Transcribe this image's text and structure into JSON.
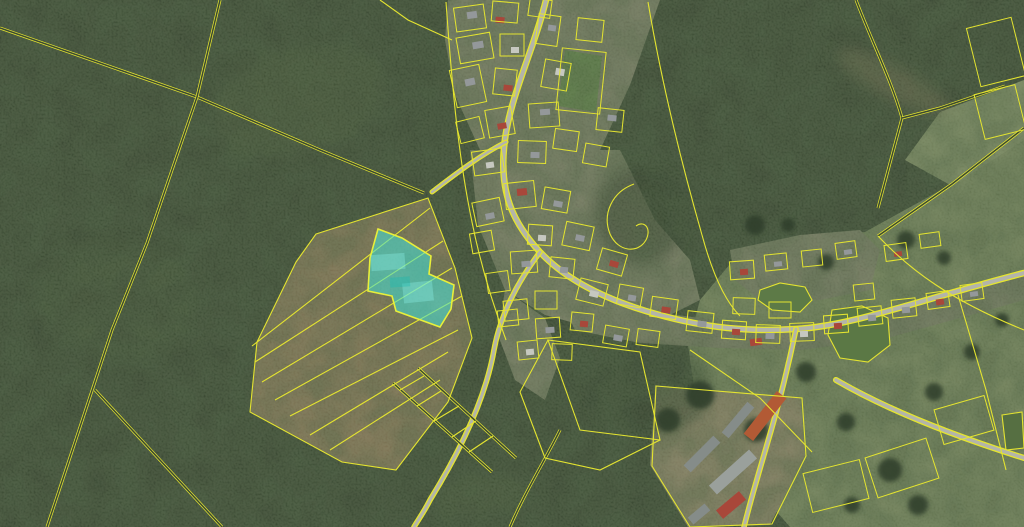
{
  "map": {
    "width": 1024,
    "height": 527,
    "colors": {
      "forest": "#3b4a34",
      "forest_core": "#3a4833",
      "village_ground": "#8f9177",
      "field_tan": "#a28a66",
      "farm_dirt": "#a79879",
      "meadow": "#8b9b6d",
      "meadow_light": "#97a677",
      "sports_green": "#6f9752",
      "road_gray": "#b3b4aa",
      "parcel_line": "#e4e430",
      "water": "#5d7a47",
      "highlight_fill": "#3fe2d7",
      "highlight_stroke": "#e8ef3a",
      "tree": "#2f3d29",
      "roofs": {
        "g": "#94989a",
        "g2": "#858c89",
        "g3": "#9aa09c",
        "r": "#a8473a",
        "o": "#b25a35",
        "w": "#c6c8c0",
        "d": "#6e756f"
      }
    },
    "regions": [
      {
        "name": "forest-base",
        "points": "0,0 1024,0 1024,527 0,527",
        "fill": "#3b4a34",
        "opacity": 1
      },
      {
        "name": "meadow-main",
        "points": "700,430 688,345 700,300 735,258 800,238 865,232 950,185 1024,135 1024,527 790,527 742,472",
        "fill": "#8b9b6d",
        "opacity": 1
      },
      {
        "name": "meadow-top-patch",
        "points": "940,112 1024,80 1024,140 952,186 905,160",
        "fill": "#97a677",
        "opacity": 1
      },
      {
        "name": "field-tan",
        "points": "316,234 428,198 455,268 472,338 448,402 396,470 342,462 250,412 257,342 296,262",
        "fill": "#a28a66",
        "opacity": 1
      },
      {
        "name": "farm-dirt",
        "points": "655,385 800,398 805,455 770,525 688,527 650,465",
        "fill": "#a79879",
        "opacity": 1
      },
      {
        "name": "village-top",
        "points": "448,0 660,0 630,85 600,150 560,160 520,160 480,150 455,95 445,40",
        "fill": "#8f9177",
        "opacity": 1
      },
      {
        "name": "village-mid",
        "points": "470,150 620,150 655,220 690,260 700,300 660,320 600,330 545,315 505,290 478,225",
        "fill": "#8f9177",
        "opacity": 1
      },
      {
        "name": "village-east-row",
        "points": "560,300 700,318 760,328 860,318 960,293 1024,270 1024,300 960,318 880,340 800,350 720,348 640,343 575,330",
        "fill": "#8f9177",
        "opacity": 1
      },
      {
        "name": "village-pond-row",
        "points": "730,250 800,235 860,230 880,250 870,290 820,300 760,300 735,280",
        "fill": "#8f9177",
        "opacity": 1
      },
      {
        "name": "village-south-tail",
        "points": "505,290 545,318 560,358 545,400 515,380 498,335",
        "fill": "#8f9177",
        "opacity": 1
      },
      {
        "name": "sports-field",
        "points": "565,50 602,56 596,112 558,106",
        "fill": "#6f9752",
        "opacity": 1
      }
    ],
    "soft_patches": [
      {
        "name": "logging-trail",
        "cx": 893,
        "cy": 82,
        "rx": 62,
        "ry": 16,
        "rot": 28,
        "fill": "#8f7f60",
        "opacity": 0.5
      },
      {
        "name": "light-forest-nw",
        "cx": 300,
        "cy": 100,
        "rx": 90,
        "ry": 55,
        "rot": -15,
        "fill": "#4d5f3d",
        "opacity": 0.5
      },
      {
        "name": "light-forest-w",
        "cx": 120,
        "cy": 300,
        "rx": 80,
        "ry": 60,
        "rot": 10,
        "fill": "#455739",
        "opacity": 0.5
      },
      {
        "name": "clearing-bottom",
        "cx": 480,
        "cy": 495,
        "rx": 50,
        "ry": 22,
        "rot": -10,
        "fill": "#4f6140",
        "opacity": 0.5
      },
      {
        "name": "dark-forest-center",
        "cx": 640,
        "cy": 215,
        "rx": 45,
        "ry": 50,
        "rot": 0,
        "fill": "#32402b",
        "opacity": 0.6
      },
      {
        "name": "forest-tongue-south",
        "cx": 650,
        "cy": 390,
        "rx": 60,
        "ry": 45,
        "rot": 0,
        "fill": "#36452e",
        "opacity": 0.6
      }
    ],
    "ponds": [
      {
        "name": "pond-west",
        "points": "760,290 780,283 805,287 812,300 800,312 772,310 758,300",
        "fill": "#5d7a47"
      },
      {
        "name": "pond-east",
        "points": "832,310 862,306 888,318 890,345 868,362 840,358 828,335",
        "fill": "#5b7845"
      },
      {
        "name": "pond-corner",
        "points": "1002,415 1022,412 1024,448 1006,450",
        "fill": "#566f42"
      }
    ],
    "roads": [
      {
        "name": "main-street",
        "d": "M 546,0 C 534,50 508,100 504,148 C 500,192 512,222 540,252 C 566,280 606,300 656,314 C 706,328 748,332 796,329 C 852,326 912,302 1024,273",
        "width": 4
      },
      {
        "name": "south-road",
        "d": "M 540,252 C 516,284 500,316 494,350 C 486,396 462,448 430,500 C 424,512 418,520 414,527",
        "width": 3
      },
      {
        "name": "farm-road",
        "d": "M 796,329 C 788,368 778,408 766,448 C 758,476 750,502 744,527",
        "width": 3
      },
      {
        "name": "southeast-road",
        "d": "M 836,380 C 884,408 948,434 1024,458",
        "width": 3.5
      },
      {
        "name": "west-spur",
        "d": "M 506,142 C 482,154 458,172 432,192",
        "width": 2.5
      }
    ],
    "double_lines": [
      {
        "name": "boundary-nw-diagonal",
        "d": "M 0,28 L 197,97 L 320,150 L 424,193"
      },
      {
        "name": "boundary-w-vertical",
        "d": "M 220,0 L 197,97 L 147,243 L 112,330 L 47,527"
      },
      {
        "name": "boundary-sw-branch",
        "d": "M 95,390 L 222,527"
      },
      {
        "name": "boundary-ne",
        "d": "M 856,0 C 872,42 892,82 902,118 L 878,208"
      },
      {
        "name": "boundary-ne-spur",
        "d": "M 902,118 L 940,108 L 1005,86"
      },
      {
        "name": "meadow-top-edge",
        "d": "M 1024,128 L 952,184 L 878,236"
      },
      {
        "name": "boundary-s-center",
        "d": "M 560,430 C 544,462 524,494 510,527"
      },
      {
        "name": "ladder-rail-1",
        "d": "M 393,383 L 492,472"
      },
      {
        "name": "ladder-rail-2",
        "d": "M 418,368 L 516,458"
      }
    ],
    "single_lines": [
      {
        "name": "field-outline",
        "d": "M 316,234 L 428,198 L 455,268 L 472,338 L 448,402 L 396,470 L 342,462 L 250,412 L 257,342 L 296,262 Z"
      },
      {
        "name": "field-strip",
        "d": "M 252,346 L 430,208"
      },
      {
        "name": "field-strip",
        "d": "M 255,362 L 443,241"
      },
      {
        "name": "field-strip",
        "d": "M 262,382 L 452,268"
      },
      {
        "name": "field-strip",
        "d": "M 275,400 L 462,296"
      },
      {
        "name": "field-strip",
        "d": "M 290,416 L 458,330"
      },
      {
        "name": "field-strip",
        "d": "M 310,435 L 448,352"
      },
      {
        "name": "field-strip",
        "d": "M 330,450 L 440,380"
      },
      {
        "name": "ladder-rung",
        "d": "M 400,390 L 424,376"
      },
      {
        "name": "ladder-rung",
        "d": "M 417,406 L 441,391"
      },
      {
        "name": "ladder-rung",
        "d": "M 434,421 L 459,406"
      },
      {
        "name": "ladder-rung",
        "d": "M 452,437 L 476,421"
      },
      {
        "name": "ladder-rung",
        "d": "M 469,452 L 493,436"
      },
      {
        "name": "meadow-line",
        "d": "M 878,236 C 910,270 950,300 1024,330"
      },
      {
        "name": "meadow-line",
        "d": "M 690,350 L 760,398 L 812,452"
      },
      {
        "name": "meadow-line",
        "d": "M 958,295 L 986,390 L 1006,470"
      },
      {
        "name": "village-east-forest-edge",
        "d": "M 648,2 C 662,85 682,165 702,235 C 712,272 724,300 740,316"
      },
      {
        "name": "village-west-edge",
        "d": "M 446,2 C 452,85 458,155 472,222 C 480,262 492,302 506,340"
      },
      {
        "name": "hook-parcel",
        "d": "M 634,184 C 612,192 602,214 610,234 C 618,252 638,254 646,240 C 652,228 644,220 636,226"
      },
      {
        "name": "south-forest-parcel",
        "d": "M 548,340 L 640,352 L 660,440 L 580,430 Z"
      },
      {
        "name": "south-forest-parcel",
        "d": "M 548,340 L 520,392 L 545,458 L 600,470 L 660,440"
      },
      {
        "name": "farm-outline",
        "d": "M 656,386 L 802,398 L 806,456 L 772,524 L 690,527 L 652,466 Z"
      },
      {
        "name": "village-top-spur",
        "d": "M 452,40 L 408,20 L 380,0"
      }
    ],
    "parcel_quads": [
      [
        470,
        18,
        30,
        24,
        -8
      ],
      [
        505,
        12,
        26,
        20,
        5
      ],
      [
        540,
        8,
        22,
        18,
        8
      ],
      [
        475,
        48,
        34,
        26,
        -10
      ],
      [
        512,
        45,
        24,
        22,
        0
      ],
      [
        548,
        30,
        22,
        30,
        8
      ],
      [
        468,
        86,
        30,
        38,
        -12
      ],
      [
        505,
        82,
        22,
        26,
        6
      ],
      [
        556,
        75,
        26,
        28,
        10
      ],
      [
        590,
        30,
        26,
        22,
        6
      ],
      [
        544,
        115,
        30,
        24,
        -4
      ],
      [
        500,
        122,
        26,
        28,
        -10
      ],
      [
        470,
        130,
        24,
        22,
        -14
      ],
      [
        532,
        152,
        28,
        22,
        2
      ],
      [
        566,
        140,
        24,
        20,
        8
      ],
      [
        488,
        162,
        30,
        24,
        -8
      ],
      [
        610,
        120,
        26,
        22,
        6
      ],
      [
        596,
        155,
        24,
        20,
        10
      ],
      [
        520,
        195,
        30,
        26,
        -6
      ],
      [
        556,
        200,
        26,
        22,
        10
      ],
      [
        488,
        212,
        28,
        24,
        -12
      ],
      [
        540,
        235,
        24,
        20,
        4
      ],
      [
        578,
        236,
        28,
        24,
        12
      ],
      [
        612,
        262,
        26,
        22,
        16
      ],
      [
        562,
        268,
        24,
        20,
        6
      ],
      [
        524,
        262,
        26,
        22,
        -4
      ],
      [
        498,
        282,
        22,
        20,
        -8
      ],
      [
        592,
        292,
        28,
        22,
        14
      ],
      [
        630,
        296,
        24,
        20,
        10
      ],
      [
        664,
        308,
        26,
        20,
        8
      ],
      [
        546,
        300,
        22,
        18,
        0
      ],
      [
        516,
        310,
        24,
        20,
        -6
      ],
      [
        482,
        242,
        22,
        20,
        -10
      ],
      [
        700,
        322,
        26,
        20,
        6
      ],
      [
        734,
        330,
        24,
        18,
        4
      ],
      [
        768,
        334,
        24,
        18,
        2
      ],
      [
        802,
        332,
        24,
        18,
        -2
      ],
      [
        836,
        324,
        24,
        18,
        -4
      ],
      [
        870,
        316,
        24,
        18,
        -6
      ],
      [
        904,
        308,
        24,
        18,
        -6
      ],
      [
        938,
        300,
        22,
        16,
        -8
      ],
      [
        972,
        292,
        22,
        16,
        -8
      ],
      [
        744,
        306,
        22,
        16,
        2
      ],
      [
        780,
        310,
        22,
        16,
        0
      ],
      [
        864,
        292,
        20,
        16,
        -6
      ],
      [
        742,
        270,
        24,
        18,
        -4
      ],
      [
        776,
        262,
        22,
        16,
        -6
      ],
      [
        812,
        258,
        20,
        16,
        -6
      ],
      [
        846,
        250,
        20,
        16,
        -8
      ],
      [
        896,
        252,
        22,
        16,
        -8
      ],
      [
        930,
        240,
        20,
        14,
        -8
      ],
      [
        548,
        328,
        24,
        20,
        -4
      ],
      [
        582,
        322,
        22,
        18,
        6
      ],
      [
        616,
        336,
        24,
        18,
        10
      ],
      [
        648,
        338,
        22,
        16,
        8
      ],
      [
        562,
        352,
        20,
        16,
        2
      ],
      [
        528,
        350,
        20,
        18,
        -6
      ],
      [
        508,
        318,
        20,
        16,
        -6
      ],
      [
        902,
        468,
        64,
        42,
        -18
      ],
      [
        964,
        420,
        52,
        36,
        -16
      ],
      [
        836,
        486,
        58,
        40,
        -14
      ],
      [
        996,
        52,
        46,
        60,
        -14
      ],
      [
        1000,
        112,
        42,
        46,
        -14
      ],
      [
        581,
        81,
        44,
        62,
        6
      ]
    ],
    "buildings": [
      [
        472,
        15,
        10,
        7,
        -8,
        "g"
      ],
      [
        500,
        20,
        9,
        6,
        5,
        "r"
      ],
      [
        478,
        45,
        11,
        7,
        -10,
        "g"
      ],
      [
        515,
        50,
        8,
        6,
        0,
        "w"
      ],
      [
        470,
        82,
        10,
        7,
        -12,
        "g"
      ],
      [
        508,
        88,
        9,
        6,
        6,
        "r"
      ],
      [
        552,
        28,
        8,
        6,
        8,
        "g"
      ],
      [
        560,
        72,
        9,
        7,
        10,
        "w"
      ],
      [
        545,
        112,
        10,
        6,
        -4,
        "g"
      ],
      [
        502,
        126,
        9,
        6,
        -10,
        "r"
      ],
      [
        535,
        155,
        9,
        6,
        2,
        "g"
      ],
      [
        490,
        165,
        8,
        6,
        -8,
        "w"
      ],
      [
        612,
        118,
        9,
        6,
        6,
        "g"
      ],
      [
        522,
        192,
        10,
        7,
        -6,
        "r"
      ],
      [
        558,
        204,
        9,
        6,
        10,
        "g"
      ],
      [
        490,
        216,
        9,
        6,
        -12,
        "g"
      ],
      [
        542,
        238,
        8,
        6,
        4,
        "w"
      ],
      [
        580,
        238,
        9,
        6,
        12,
        "g"
      ],
      [
        614,
        264,
        9,
        6,
        16,
        "r"
      ],
      [
        564,
        270,
        8,
        6,
        6,
        "g"
      ],
      [
        526,
        264,
        9,
        6,
        -4,
        "g"
      ],
      [
        594,
        294,
        9,
        6,
        14,
        "w"
      ],
      [
        632,
        298,
        8,
        6,
        10,
        "g"
      ],
      [
        666,
        310,
        9,
        6,
        8,
        "r"
      ],
      [
        702,
        324,
        9,
        6,
        6,
        "g"
      ],
      [
        736,
        332,
        8,
        6,
        4,
        "r"
      ],
      [
        770,
        336,
        9,
        6,
        2,
        "g"
      ],
      [
        804,
        334,
        8,
        6,
        -2,
        "w"
      ],
      [
        838,
        326,
        8,
        6,
        -4,
        "r"
      ],
      [
        872,
        318,
        8,
        6,
        -6,
        "g"
      ],
      [
        906,
        310,
        8,
        6,
        -6,
        "g"
      ],
      [
        940,
        302,
        8,
        6,
        -8,
        "r"
      ],
      [
        974,
        294,
        8,
        5,
        -8,
        "g"
      ],
      [
        744,
        272,
        8,
        6,
        -4,
        "r"
      ],
      [
        778,
        264,
        8,
        5,
        -6,
        "g"
      ],
      [
        848,
        252,
        8,
        5,
        -8,
        "g"
      ],
      [
        898,
        254,
        8,
        5,
        -8,
        "r"
      ],
      [
        550,
        330,
        9,
        6,
        -4,
        "g"
      ],
      [
        584,
        324,
        8,
        6,
        6,
        "r"
      ],
      [
        618,
        338,
        9,
        6,
        10,
        "g"
      ],
      [
        530,
        352,
        8,
        6,
        -6,
        "w"
      ],
      [
        756,
        342,
        12,
        7,
        -8,
        "r"
      ],
      [
        765,
        416,
        54,
        12,
        -52,
        "o"
      ],
      [
        738,
        420,
        40,
        9,
        -50,
        "g2"
      ],
      [
        702,
        454,
        42,
        10,
        -45,
        "g2"
      ],
      [
        733,
        472,
        54,
        12,
        -42,
        "g3"
      ],
      [
        731,
        505,
        30,
        11,
        -40,
        "r"
      ],
      [
        699,
        514,
        22,
        9,
        -40,
        "g2"
      ]
    ],
    "trees": [
      [
        755,
        225,
        10
      ],
      [
        788,
        225,
        7
      ],
      [
        826,
        262,
        8
      ],
      [
        906,
        240,
        9
      ],
      [
        944,
        258,
        7
      ],
      [
        756,
        430,
        12
      ],
      [
        806,
        372,
        10
      ],
      [
        846,
        422,
        9
      ],
      [
        890,
        470,
        12
      ],
      [
        934,
        392,
        9
      ],
      [
        972,
        352,
        8
      ],
      [
        1002,
        320,
        7
      ],
      [
        918,
        505,
        10
      ],
      [
        852,
        505,
        8
      ],
      [
        700,
        395,
        14
      ],
      [
        668,
        420,
        12
      ]
    ],
    "highlight_parcel": {
      "points": "378,229 402,238 431,256 429,274 454,285 451,309 440,327 396,311 392,296 368,291 370,258",
      "fill": "#3fe2d7",
      "fill_opacity": 0.55,
      "stroke": "#e8ef3a",
      "inner_shapes": [
        {
          "cx": 388,
          "cy": 262,
          "w": 34,
          "h": 16,
          "rot": -4,
          "fill": "#8cf2e9",
          "opacity": 0.35
        },
        {
          "cx": 418,
          "cy": 292,
          "w": 30,
          "h": 20,
          "rot": -6,
          "fill": "#8cf2e9",
          "opacity": 0.35
        },
        {
          "cx": 400,
          "cy": 282,
          "w": 20,
          "h": 10,
          "rot": -4,
          "fill": "#1fb9af",
          "opacity": 0.4
        }
      ]
    }
  }
}
